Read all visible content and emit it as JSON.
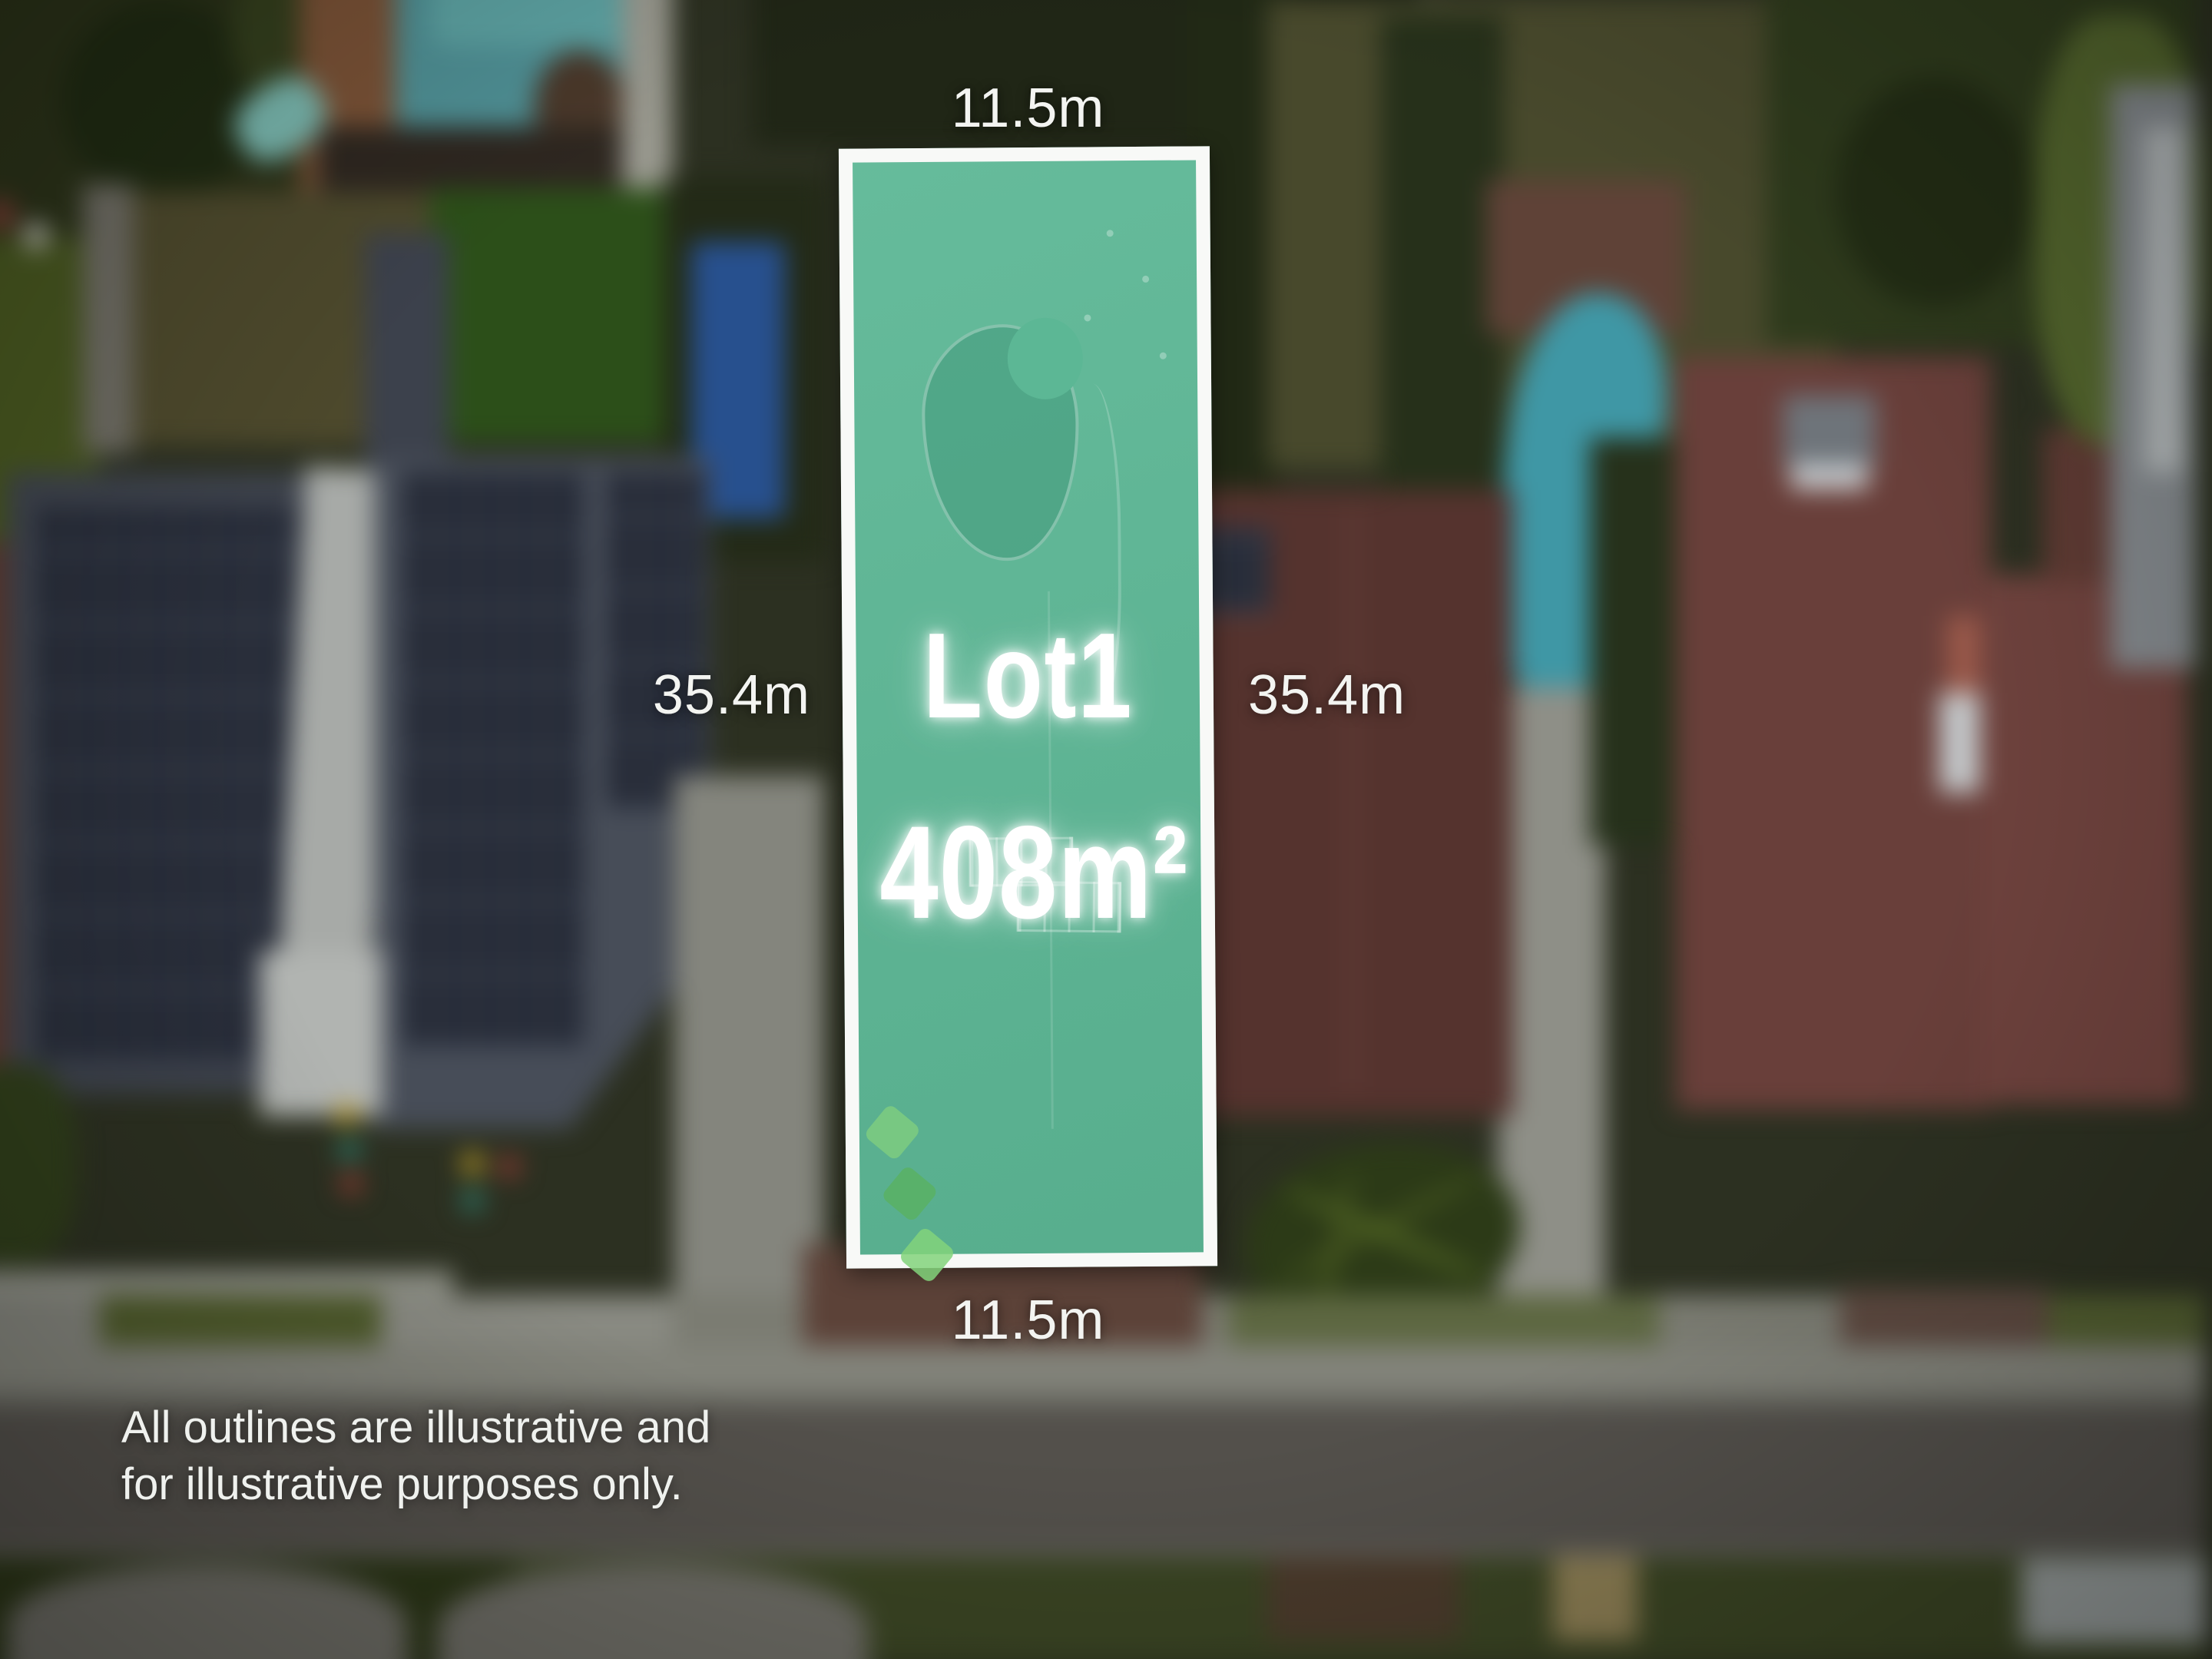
{
  "lot": {
    "name": "Lot1",
    "area": "408m²"
  },
  "dimensions": {
    "top": "11.5m",
    "bottom": "11.5m",
    "left": "35.4m",
    "right": "35.4m"
  },
  "disclaimer": {
    "line1": "All outlines are illustrative and",
    "line2": "for illustrative purposes only."
  },
  "colors": {
    "lot_fill": "#5CB795",
    "lot_border": "#F8F9F7",
    "label_text": "#F3F4F1"
  }
}
